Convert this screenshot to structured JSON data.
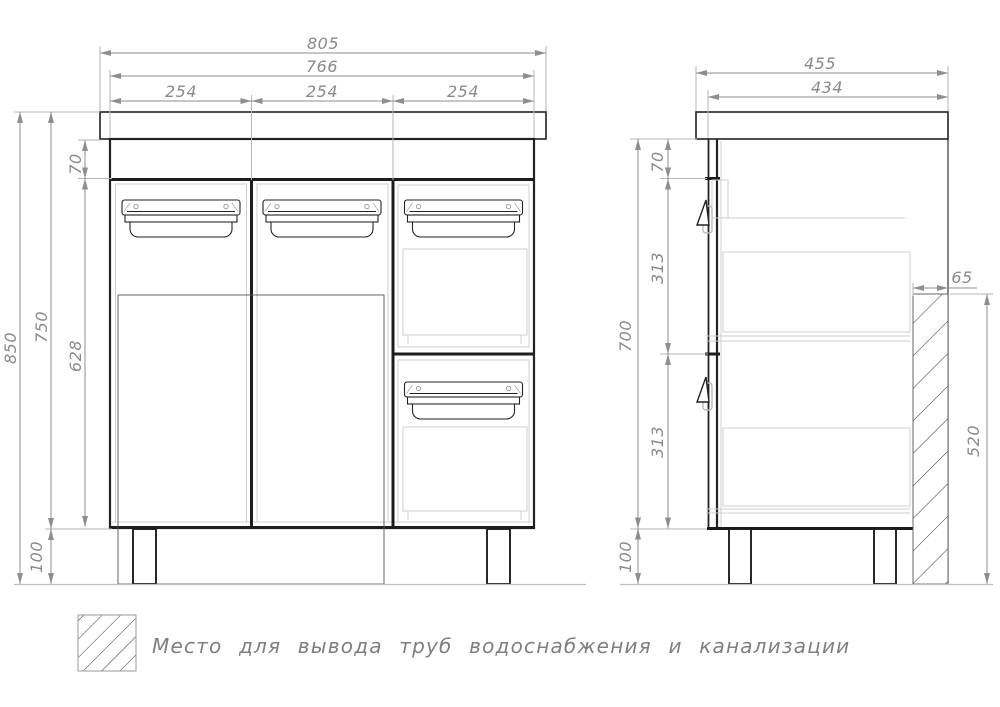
{
  "front_view": {
    "top_dims": {
      "total_width": "805",
      "cabinet_width": "766",
      "section_widths": [
        "254",
        "254",
        "254"
      ]
    },
    "left_dims": {
      "total_height": "850",
      "height_without_legs": "750",
      "apron_height": "70",
      "door_height": "628",
      "leg_height": "100"
    }
  },
  "side_view": {
    "top_dims": {
      "total_depth": "455",
      "cabinet_depth": "434"
    },
    "left_dims": {
      "apron_height": "70",
      "upper_drawer_height": "313",
      "body_height": "700",
      "lower_drawer_height": "313",
      "leg_height": "100"
    },
    "right_dims": {
      "pipe_zone_depth": "65",
      "pipe_zone_height": "520"
    }
  },
  "legend": {
    "swatch": "diagonal-hatch",
    "text": "Место для вывода труб водоснабжения и канализации"
  },
  "colors": {
    "outline": "#222222",
    "light_detail": "#cfcfcf",
    "dimension_gray": "#8e8e8e",
    "background": "#ffffff"
  }
}
